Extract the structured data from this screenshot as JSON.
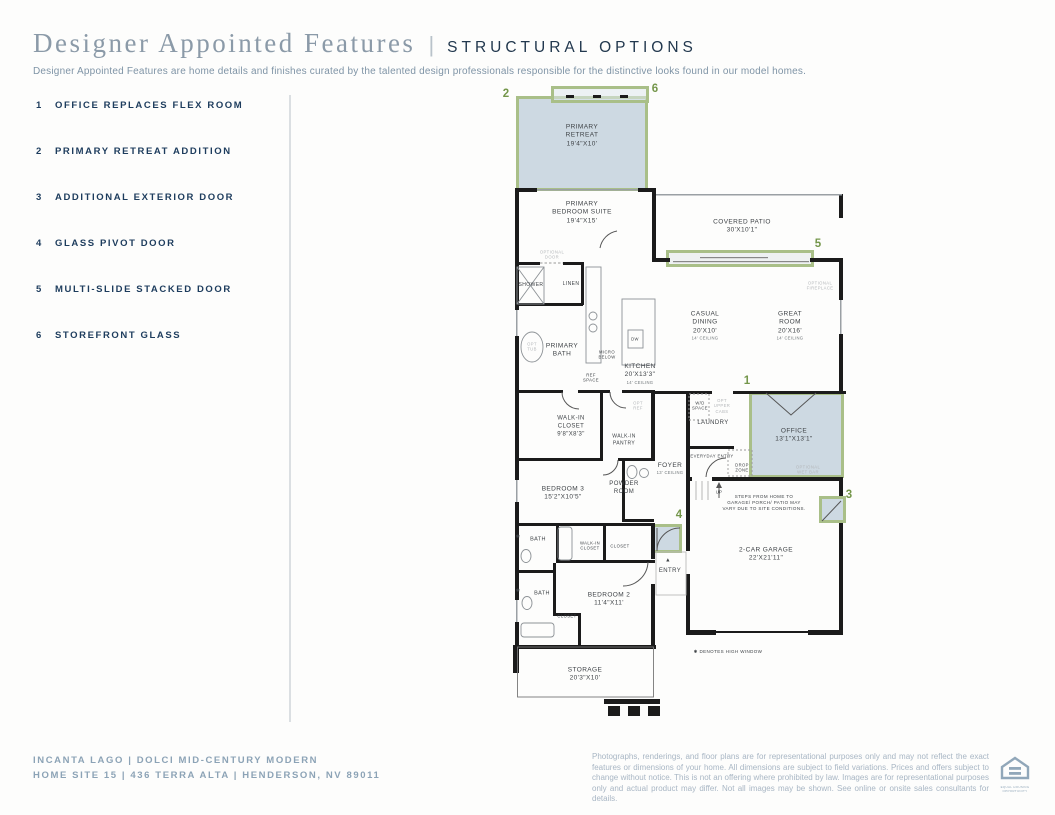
{
  "header": {
    "title": "Designer Appointed Features",
    "divider": "|",
    "subtitle": "STRUCTURAL OPTIONS",
    "description": "Designer Appointed Features are home details and finishes curated by the talented design professionals responsible for the distinctive looks found in our model homes."
  },
  "options": [
    {
      "num": "1",
      "label": "OFFICE REPLACES FLEX ROOM"
    },
    {
      "num": "2",
      "label": "PRIMARY RETREAT ADDITION"
    },
    {
      "num": "3",
      "label": "ADDITIONAL EXTERIOR DOOR"
    },
    {
      "num": "4",
      "label": "GLASS PIVOT DOOR"
    },
    {
      "num": "5",
      "label": "MULTI-SLIDE STACKED DOOR"
    },
    {
      "num": "6",
      "label": "STOREFRONT GLASS"
    }
  ],
  "colors": {
    "accent_green": "#a9bf88",
    "marker_green": "#74964a",
    "highlight_fill": "#cdd9e2",
    "navy": "#1d3c5d",
    "muted_blue": "#8ca3b6"
  },
  "floorplan": {
    "highlights": [
      {
        "name": "primary-retreat-addition",
        "option": "2",
        "x": 516,
        "y": 96,
        "w": 132,
        "h": 95,
        "fill": "#cdd9e2"
      },
      {
        "name": "storefront-glass",
        "option": "6",
        "x": 551,
        "y": 86,
        "w": 98,
        "h": 17,
        "fill": "rgba(223,231,237,0.55)"
      },
      {
        "name": "multi-slide-stacked-door",
        "option": "5",
        "x": 666,
        "y": 250,
        "w": 148,
        "h": 17,
        "fill": "#eef1f2"
      },
      {
        "name": "office-replaces-flex",
        "option": "1",
        "x": 749,
        "y": 392,
        "w": 95,
        "h": 86,
        "fill": "#cdd9e2"
      },
      {
        "name": "additional-exterior-door",
        "option": "3",
        "x": 819,
        "y": 496,
        "w": 27,
        "h": 27,
        "fill": "#cdd9e2"
      },
      {
        "name": "glass-pivot-door",
        "option": "4",
        "x": 652,
        "y": 524,
        "w": 30,
        "h": 29,
        "fill": "#cdd9e2"
      }
    ],
    "markers": [
      {
        "n": "2",
        "x": 506,
        "y": 94
      },
      {
        "n": "6",
        "x": 655,
        "y": 89
      },
      {
        "n": "5",
        "x": 818,
        "y": 244
      },
      {
        "n": "1",
        "x": 747,
        "y": 381
      },
      {
        "n": "3",
        "x": 849,
        "y": 495
      },
      {
        "n": "4",
        "x": 679,
        "y": 515
      }
    ],
    "labels": [
      {
        "name": "primary-retreat",
        "lines": [
          "PRIMARY",
          "RETREAT",
          "19'4\"X10'"
        ],
        "x": 582,
        "y": 136,
        "fs": 6.5
      },
      {
        "name": "primary-bedroom-suite",
        "lines": [
          "PRIMARY",
          "BEDROOM SUITE",
          "19'4\"X15'"
        ],
        "x": 582,
        "y": 213,
        "fs": 6.5
      },
      {
        "name": "covered-patio",
        "lines": [
          "COVERED PATIO",
          "30'X10'1\""
        ],
        "x": 742,
        "y": 227,
        "fs": 6.5
      },
      {
        "name": "optional-door",
        "lines": [
          "OPTIONAL",
          "DOOR"
        ],
        "x": 552,
        "y": 255,
        "fs": 4.2,
        "muted": true
      },
      {
        "name": "shower",
        "lines": [
          "SHOWER"
        ],
        "x": 531,
        "y": 285,
        "fs": 5
      },
      {
        "name": "linen",
        "lines": [
          "LINEN"
        ],
        "x": 571,
        "y": 284,
        "fs": 5
      },
      {
        "name": "opt-tub",
        "lines": [
          "OPT",
          "TUB"
        ],
        "x": 532,
        "y": 347,
        "fs": 4.2,
        "muted": true
      },
      {
        "name": "primary-bath",
        "lines": [
          "PRIMARY",
          "BATH"
        ],
        "x": 562,
        "y": 351,
        "fs": 6.5
      },
      {
        "name": "micro-below",
        "lines": [
          "MICRO",
          "BELOW"
        ],
        "x": 607,
        "y": 355,
        "fs": 4.2
      },
      {
        "name": "dw",
        "lines": [
          "DW"
        ],
        "x": 635,
        "y": 339,
        "fs": 4.2
      },
      {
        "name": "ref-space",
        "lines": [
          "REF",
          "SPACE"
        ],
        "x": 591,
        "y": 378,
        "fs": 4.2
      },
      {
        "name": "kitchen",
        "lines": [
          "KITCHEN",
          "20'X13'3\""
        ],
        "sub": [
          "14' CEILING"
        ],
        "x": 640,
        "y": 374,
        "fs": 6.5
      },
      {
        "name": "casual-dining",
        "lines": [
          "CASUAL",
          "DINING",
          "20'X10'"
        ],
        "sub": [
          "14' CEILING"
        ],
        "x": 705,
        "y": 326,
        "fs": 6.5
      },
      {
        "name": "great-room",
        "lines": [
          "GREAT",
          "ROOM",
          "20'X16'"
        ],
        "sub": [
          "14' CEILING"
        ],
        "x": 790,
        "y": 326,
        "fs": 6.5
      },
      {
        "name": "optional-fireplace",
        "lines": [
          "OPTIONAL",
          "FIREPLACE"
        ],
        "x": 820,
        "y": 286,
        "fs": 4.2,
        "muted": true
      },
      {
        "name": "wd-space",
        "lines": [
          "W/D",
          "SPACE"
        ],
        "x": 700,
        "y": 406,
        "fs": 4.2
      },
      {
        "name": "opt-upper-cabs",
        "lines": [
          "OPT",
          "UPPER",
          "CABS"
        ],
        "x": 722,
        "y": 406,
        "fs": 4.2,
        "muted": true
      },
      {
        "name": "laundry",
        "lines": [
          "LAUNDRY"
        ],
        "x": 713,
        "y": 424,
        "fs": 6
      },
      {
        "name": "office",
        "lines": [
          "OFFICE",
          "13'1\"X13'1\""
        ],
        "x": 794,
        "y": 436,
        "fs": 6.5
      },
      {
        "name": "optional-wet-bar",
        "lines": [
          "OPTIONAL",
          "WET BAR"
        ],
        "x": 808,
        "y": 470,
        "fs": 4.2,
        "muted": true
      },
      {
        "name": "opt-ref",
        "lines": [
          "OPT",
          "REF"
        ],
        "x": 638,
        "y": 406,
        "fs": 4.2,
        "muted": true
      },
      {
        "name": "walk-in-closet",
        "lines": [
          "WALK-IN",
          "CLOSET",
          "9'8\"X8'3\""
        ],
        "x": 571,
        "y": 427,
        "fs": 6
      },
      {
        "name": "walk-in-pantry",
        "lines": [
          "WALK-IN",
          "PANTRY"
        ],
        "x": 624,
        "y": 440,
        "fs": 5
      },
      {
        "name": "everyday-entry",
        "lines": [
          "EVERYDAY ENTRY"
        ],
        "x": 712,
        "y": 456,
        "fs": 4.2
      },
      {
        "name": "drop-zone",
        "lines": [
          "DROP",
          "ZONE"
        ],
        "x": 742,
        "y": 468,
        "fs": 4.2
      },
      {
        "name": "up",
        "lines": [
          "UP"
        ],
        "x": 719,
        "y": 492,
        "fs": 4.2
      },
      {
        "name": "foyer",
        "lines": [
          "FOYER"
        ],
        "sub": [
          "13' CEILING"
        ],
        "x": 670,
        "y": 469,
        "fs": 6.5
      },
      {
        "name": "powder-room",
        "lines": [
          "POWDER",
          "ROOM"
        ],
        "x": 624,
        "y": 489,
        "fs": 6
      },
      {
        "name": "bedroom-3",
        "lines": [
          "BEDROOM 3",
          "15'2\"X10'5\""
        ],
        "x": 563,
        "y": 494,
        "fs": 6.5
      },
      {
        "name": "steps-note",
        "lines": [
          "STEPS FROM HOME TO",
          "GARAGE/ PORCH/ PATIO MAY",
          "VARY DUE TO SITE CONDITIONS."
        ],
        "x": 764,
        "y": 503,
        "fs": 4.5
      },
      {
        "name": "garage",
        "lines": [
          "2-CAR GARAGE",
          "22'X21'11\""
        ],
        "x": 766,
        "y": 555,
        "fs": 6.5
      },
      {
        "name": "bath-1",
        "lines": [
          "BATH"
        ],
        "x": 538,
        "y": 540,
        "fs": 5.5
      },
      {
        "name": "walk-in-closet-2",
        "lines": [
          "WALK-IN",
          "CLOSET"
        ],
        "x": 590,
        "y": 546,
        "fs": 4.2
      },
      {
        "name": "closet-1",
        "lines": [
          "CLOSET"
        ],
        "x": 620,
        "y": 546,
        "fs": 4.2
      },
      {
        "name": "bath-2",
        "lines": [
          "BATH"
        ],
        "x": 542,
        "y": 594,
        "fs": 5.5
      },
      {
        "name": "closet-2",
        "lines": [
          "CLOSET"
        ],
        "x": 567,
        "y": 616,
        "fs": 4.2
      },
      {
        "name": "bedroom-2",
        "lines": [
          "BEDROOM 2",
          "11'4\"X11'"
        ],
        "x": 609,
        "y": 600,
        "fs": 6.5
      },
      {
        "name": "entry-arrow",
        "lines": [
          "▲"
        ],
        "x": 668,
        "y": 561,
        "fs": 5.5
      },
      {
        "name": "entry",
        "lines": [
          "ENTRY"
        ],
        "x": 670,
        "y": 572,
        "fs": 6
      },
      {
        "name": "storage",
        "lines": [
          "STORAGE",
          "20'3\"X10'"
        ],
        "x": 585,
        "y": 675,
        "fs": 6.5
      },
      {
        "name": "high-window-marker-1",
        "lines": [
          "✱"
        ],
        "x": 518,
        "y": 537,
        "fs": 5
      },
      {
        "name": "high-window-marker-2",
        "lines": [
          "✱"
        ],
        "x": 518,
        "y": 591,
        "fs": 5
      },
      {
        "name": "high-window-note",
        "lines": [
          "✱ DENOTES HIGH WINDOW"
        ],
        "x": 728,
        "y": 652,
        "fs": 4.5
      }
    ]
  },
  "footer": {
    "line1": "INCANTA LAGO   |   DOLCI MID-CENTURY MODERN",
    "line2": "HOME SITE 15   |   436 TERRA ALTA   |   HENDERSON, NV 89011",
    "disclaimer": "Photographs, renderings, and floor plans are for representational purposes only and may not reflect the exact features or dimensions of your home. All dimensions are subject to field variations. Prices and offers subject to change without notice. This is not an offering where prohibited by law. Images are for representational purposes only and actual product may differ. Not all images may be shown. See online or onsite sales consultants for details.",
    "logo_caption": "EQUAL HOUSING OPPORTUNITY"
  }
}
